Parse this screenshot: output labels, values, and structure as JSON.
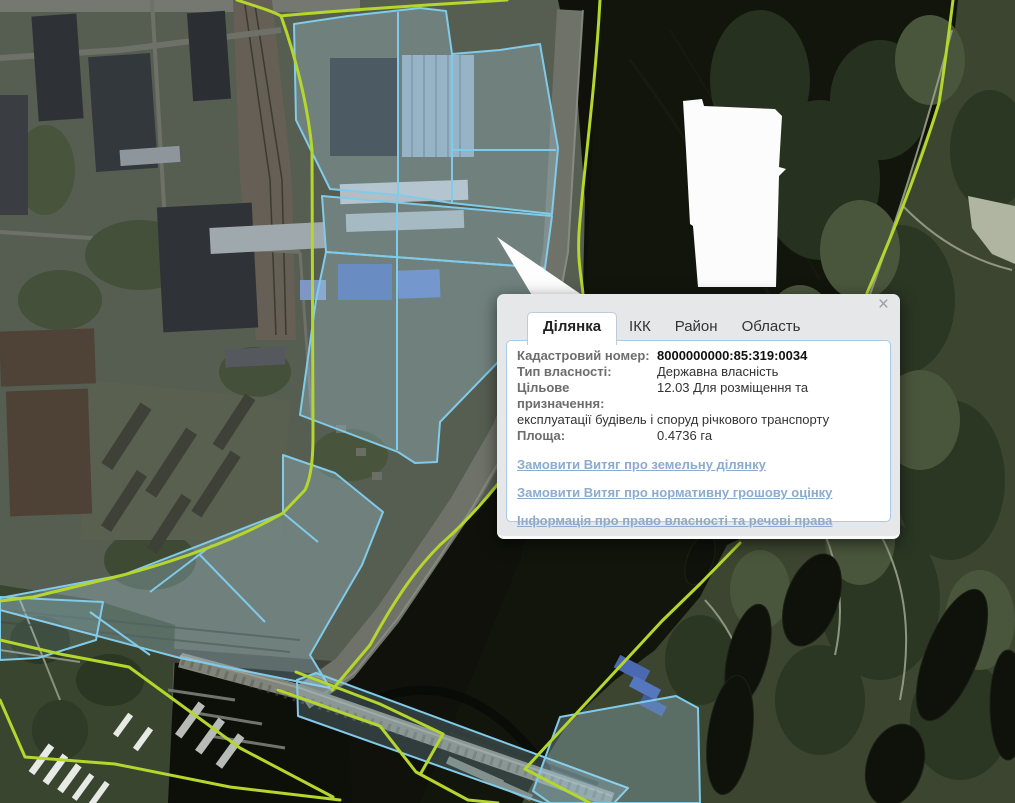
{
  "popup": {
    "close_icon": "×",
    "tabs": [
      {
        "label": "Ділянка",
        "active": true
      },
      {
        "label": "ІКК",
        "active": false
      },
      {
        "label": "Район",
        "active": false
      },
      {
        "label": "Область",
        "active": false
      }
    ],
    "fields": [
      {
        "label": "Кадастровий номер:",
        "value": "8000000000:85:319:0034"
      },
      {
        "label": "Тип власності:",
        "value": "Державна власність"
      },
      {
        "label": "Цільове призначення:",
        "value": "12.03 Для розміщення та експлуатації будівель і споруд річкового транспорту"
      },
      {
        "label": "Площа:",
        "value": "0.4736 га"
      }
    ],
    "links": [
      {
        "text": "Замовити Витяг про земельну ділянку"
      },
      {
        "text": "Замовити Витяг про нормативну грошову оцінку"
      },
      {
        "text": "Інформація про право власності та речові права"
      }
    ]
  },
  "map": {
    "colors": {
      "parcel_outline": "#80cbe9",
      "parcel_fill": "rgba(175,220,240,0.28)",
      "boundary_line": "#b5d62c",
      "masked_area": "#fcfcfc",
      "water": "#0f110a"
    }
  }
}
